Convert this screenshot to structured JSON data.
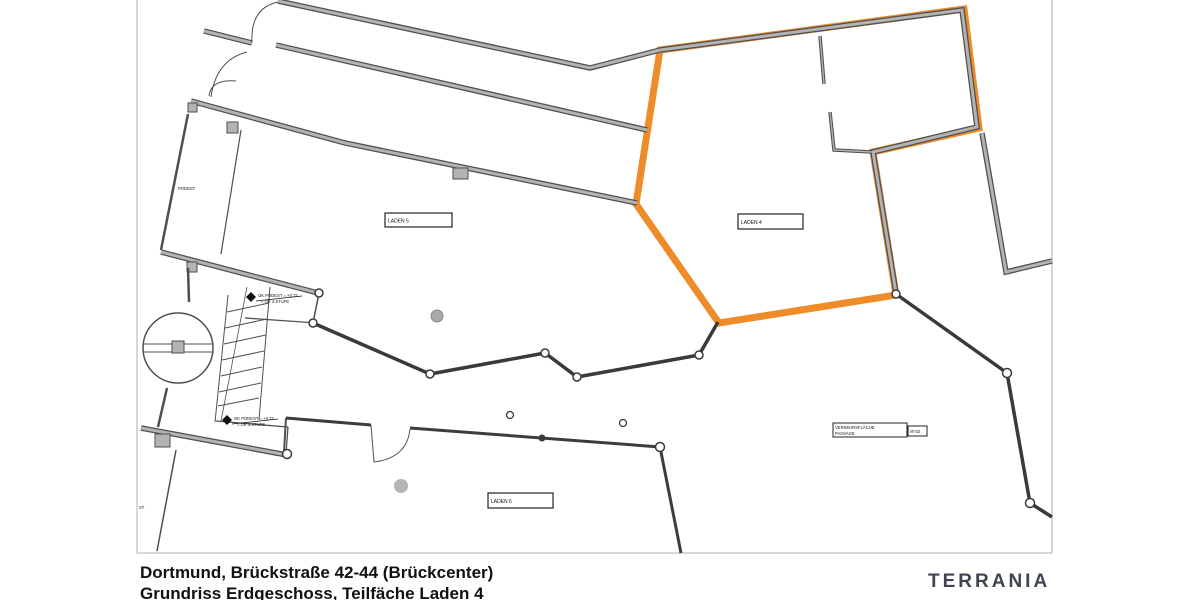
{
  "title_block": {
    "line1": "Dortmund, Brückstraße 42-44 (Brückcenter)",
    "line2": "Grundriss Erdgeschoss, Teilfäche Laden 4"
  },
  "branding": {
    "logo": "TERRANIA"
  },
  "plan": {
    "labels": {
      "laden5": "LADEN 5",
      "laden4": "LADEN 4",
      "laden6": "LADEN 6",
      "podest": "PODEST",
      "verkehrsflaeche": "VERKEHRSFLÄCHE",
      "passage": "PASSAGE",
      "vf": "VF.02",
      "st": "ST"
    },
    "annotations": {
      "level_line1": "OK PODEST = +0.72",
      "level_line2": "= OK 4.STUFE"
    },
    "colors": {
      "highlight": "#ee8c2a",
      "wall_fill": "#b3b3b3",
      "wall_outline": "#4f4f4f",
      "line": "#3a3a3a",
      "frame": "#cccccc",
      "logo": "#3e4450"
    }
  }
}
